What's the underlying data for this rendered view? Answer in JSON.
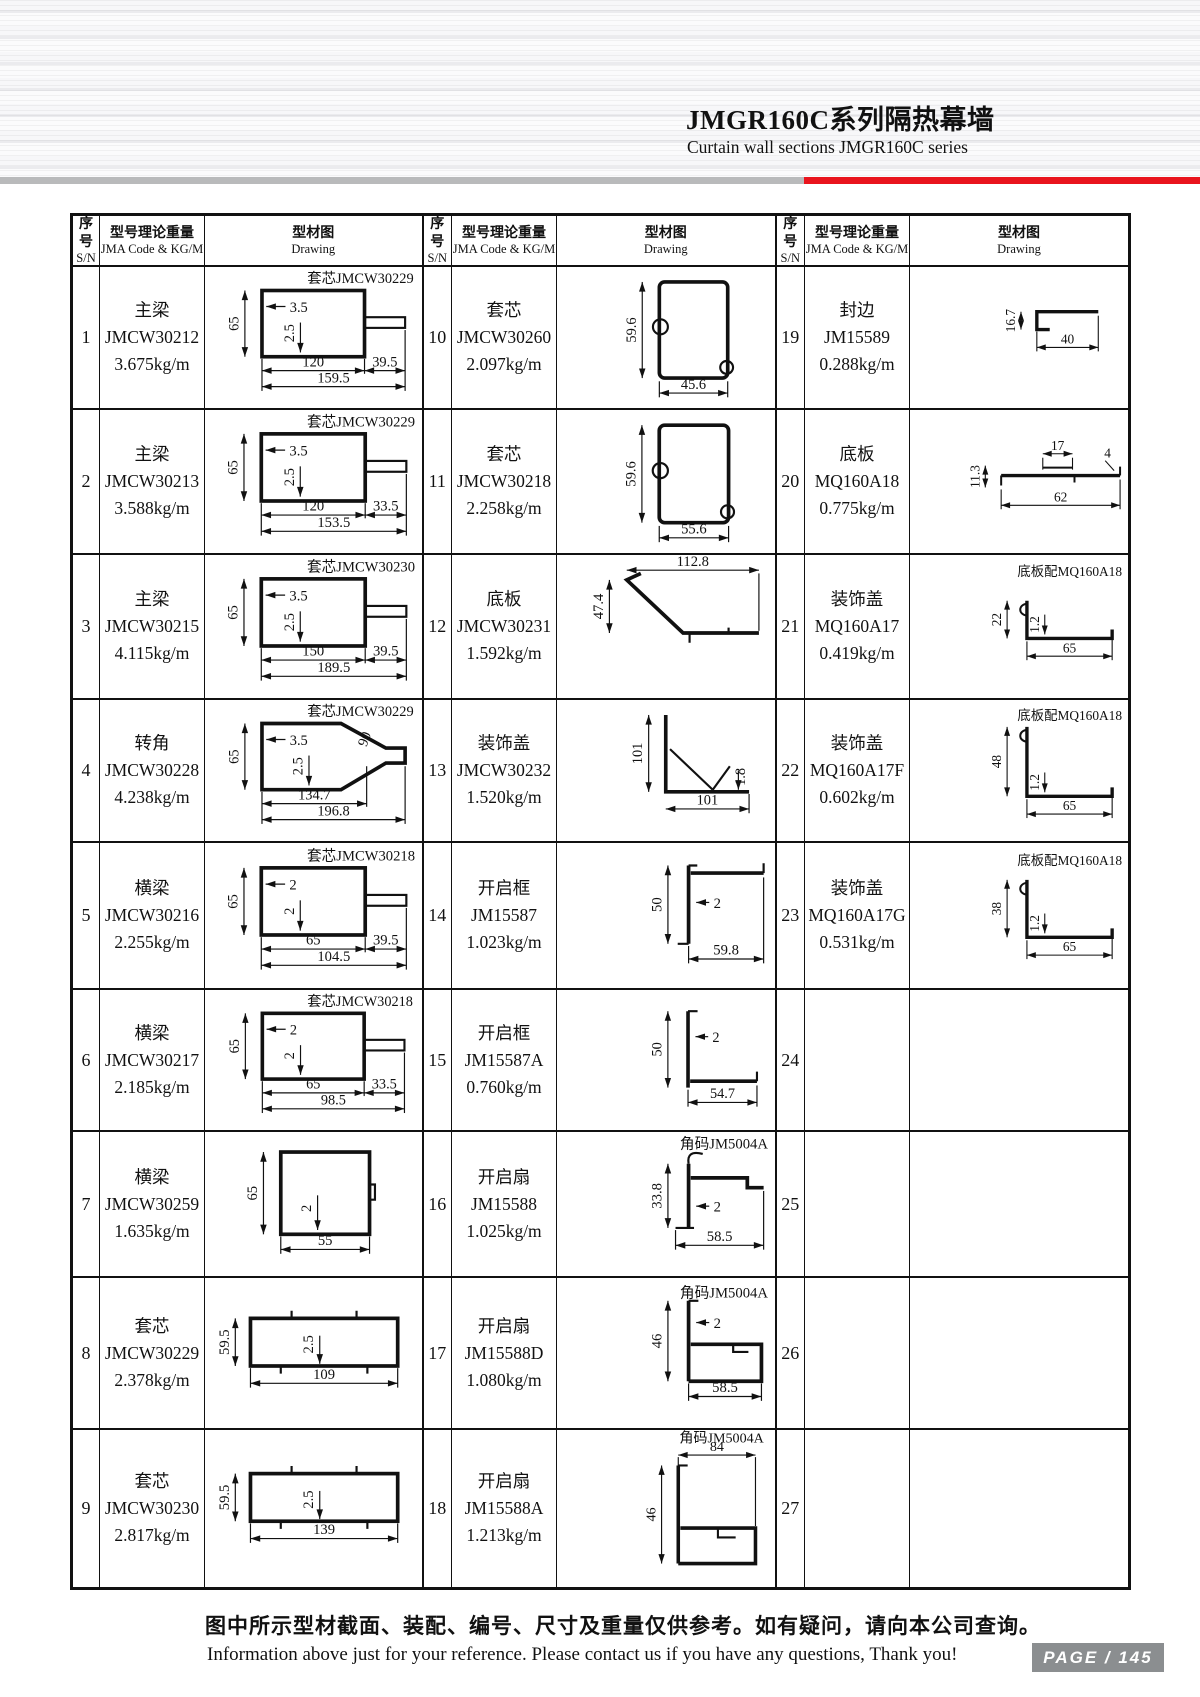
{
  "header": {
    "title_cn": "JMGR160C系列隔热幕墙",
    "title_en": "Curtain wall sections JMGR160C series"
  },
  "colors": {
    "accent_red": "#e9141d",
    "bar_gray": "#b9babb",
    "page_box_gray": "#8b8e90",
    "line_black": "#111111"
  },
  "table": {
    "col_headers": {
      "sn_cn": "序号",
      "sn_en": "S/N",
      "code_cn": "型号理论重量",
      "code_en": "JMA Code & KG/M",
      "draw_cn": "型材图",
      "draw_en": "Drawing"
    },
    "cells": [
      {
        "sn": "1",
        "name": "主梁",
        "code": "JMCW30212",
        "weight": "3.675kg/m",
        "note": "套芯JMCW30229",
        "shape": "recttab",
        "dims": {
          "h": "65",
          "t1": "3.5",
          "t2": "2.5",
          "w1": "120",
          "w2": "39.5",
          "w3": "159.5"
        }
      },
      {
        "sn": "2",
        "name": "主梁",
        "code": "JMCW30213",
        "weight": "3.588kg/m",
        "note": "套芯JMCW30229",
        "shape": "recttab",
        "dims": {
          "h": "65",
          "t1": "3.5",
          "t2": "2.5",
          "w1": "120",
          "w2": "33.5",
          "w3": "153.5"
        }
      },
      {
        "sn": "3",
        "name": "主梁",
        "code": "JMCW30215",
        "weight": "4.115kg/m",
        "note": "套芯JMCW30230",
        "shape": "recttab",
        "dims": {
          "h": "65",
          "t1": "3.5",
          "t2": "2.5",
          "w1": "150",
          "w2": "39.5",
          "w3": "189.5"
        }
      },
      {
        "sn": "4",
        "name": "转角",
        "code": "JMCW30228",
        "weight": "4.238kg/m",
        "note": "套芯JMCW30229",
        "shape": "corner",
        "dims": {
          "h": "65",
          "t1": "3.5",
          "t2": "2.5",
          "a": "90",
          "w1": "134.7",
          "w3": "196.8"
        }
      },
      {
        "sn": "5",
        "name": "横梁",
        "code": "JMCW30216",
        "weight": "2.255kg/m",
        "note": "套芯JMCW30218",
        "shape": "recttab",
        "dims": {
          "h": "65",
          "t1": "2",
          "t2": "2",
          "w1": "65",
          "w2": "39.5",
          "w3": "104.5"
        }
      },
      {
        "sn": "6",
        "name": "横梁",
        "code": "JMCW30217",
        "weight": "2.185kg/m",
        "note": "套芯JMCW30218",
        "shape": "recttab",
        "dims": {
          "h": "65",
          "t1": "2",
          "t2": "2",
          "w1": "65",
          "w2": "33.5",
          "w3": "98.5"
        }
      },
      {
        "sn": "7",
        "name": "横梁",
        "code": "JMCW30259",
        "weight": "1.635kg/m",
        "note": "",
        "shape": "square",
        "dims": {
          "h": "65",
          "t": "2",
          "w": "55"
        }
      },
      {
        "sn": "8",
        "name": "套芯",
        "code": "JMCW30229",
        "weight": "2.378kg/m",
        "note": "",
        "shape": "hrect",
        "dims": {
          "h": "59.5",
          "t": "2.5",
          "w": "109"
        }
      },
      {
        "sn": "9",
        "name": "套芯",
        "code": "JMCW30230",
        "weight": "2.817kg/m",
        "note": "",
        "shape": "hrect",
        "dims": {
          "h": "59.5",
          "t": "2.5",
          "w": "139"
        }
      },
      {
        "sn": "10",
        "name": "套芯",
        "code": "JMCW30260",
        "weight": "2.097kg/m",
        "note": "",
        "shape": "vprof",
        "dims": {
          "h": "59.6",
          "w": "45.6"
        }
      },
      {
        "sn": "11",
        "name": "套芯",
        "code": "JMCW30218",
        "weight": "2.258kg/m",
        "note": "",
        "shape": "vprof",
        "dims": {
          "h": "59.6",
          "w": "55.6"
        }
      },
      {
        "sn": "12",
        "name": "底板",
        "code": "JMCW30231",
        "weight": "1.592kg/m",
        "note": "",
        "shape": "slope",
        "dims": {
          "w": "112.8",
          "h": "47.4"
        }
      },
      {
        "sn": "13",
        "name": "装饰盖",
        "code": "JMCW30232",
        "weight": "1.520kg/m",
        "note": "",
        "shape": "anglel",
        "dims": {
          "h": "101",
          "t": "1.8",
          "w": "101"
        }
      },
      {
        "sn": "14",
        "name": "开启框",
        "code": "JM15587",
        "weight": "1.023kg/m",
        "note": "",
        "shape": "frame14",
        "dims": {
          "h": "50",
          "t": "2",
          "w": "59.8"
        }
      },
      {
        "sn": "15",
        "name": "开启框",
        "code": "JM15587A",
        "weight": "0.760kg/m",
        "note": "",
        "shape": "frame15",
        "dims": {
          "h": "50",
          "t": "2",
          "w": "54.7"
        }
      },
      {
        "sn": "16",
        "name": "开启扇",
        "code": "JM15588",
        "weight": "1.025kg/m",
        "note": "角码JM5004A",
        "shape": "sash16",
        "dims": {
          "h": "33.8",
          "t": "2",
          "w": "58.5"
        }
      },
      {
        "sn": "17",
        "name": "开启扇",
        "code": "JM15588D",
        "weight": "1.080kg/m",
        "note": "角码JM5004A",
        "shape": "sash17",
        "dims": {
          "h": "46",
          "t": "2",
          "w": "58.5"
        }
      },
      {
        "sn": "18",
        "name": "开启扇",
        "code": "JM15588A",
        "weight": "1.213kg/m",
        "note": "角码JM5004A",
        "shape": "sash18",
        "dims": {
          "w": "84",
          "h": "46"
        }
      },
      {
        "sn": "19",
        "name": "封边",
        "code": "JM15589",
        "weight": "0.288kg/m",
        "note": "",
        "shape": "edge",
        "dims": {
          "h": "16.7",
          "w": "40"
        }
      },
      {
        "sn": "20",
        "name": "底板",
        "code": "MQ160A18",
        "weight": "0.775kg/m",
        "note": "",
        "shape": "plate",
        "dims": {
          "t1": "17",
          "t2": "4",
          "h": "11.3",
          "w": "62"
        }
      },
      {
        "sn": "21",
        "name": "装饰盖",
        "code": "MQ160A17",
        "weight": "0.419kg/m",
        "note": "底板配MQ160A18",
        "shape": "ushape",
        "dims": {
          "h": "22",
          "t": "1.2",
          "w": "65"
        }
      },
      {
        "sn": "22",
        "name": "装饰盖",
        "code": "MQ160A17F",
        "weight": "0.602kg/m",
        "note": "底板配MQ160A18",
        "shape": "ushape",
        "dims": {
          "h": "48",
          "t": "1.2",
          "w": "65"
        }
      },
      {
        "sn": "23",
        "name": "装饰盖",
        "code": "MQ160A17G",
        "weight": "0.531kg/m",
        "note": "底板配MQ160A18",
        "shape": "ushape",
        "dims": {
          "h": "38",
          "t": "1.2",
          "w": "65"
        }
      },
      {
        "sn": "24",
        "name": "",
        "code": "",
        "weight": "",
        "note": "",
        "shape": "",
        "dims": {}
      },
      {
        "sn": "25",
        "name": "",
        "code": "",
        "weight": "",
        "note": "",
        "shape": "",
        "dims": {}
      },
      {
        "sn": "26",
        "name": "",
        "code": "",
        "weight": "",
        "note": "",
        "shape": "",
        "dims": {}
      },
      {
        "sn": "27",
        "name": "",
        "code": "",
        "weight": "",
        "note": "",
        "shape": "",
        "dims": {}
      }
    ]
  },
  "footer": {
    "note_cn": "图中所示型材截面、装配、编号、尺寸及重量仅供参考。如有疑问，请向本公司查询。",
    "note_en": "Information above just for your reference. Please contact us if you have any questions, Thank you!",
    "page_label": "PAGE / 145"
  }
}
